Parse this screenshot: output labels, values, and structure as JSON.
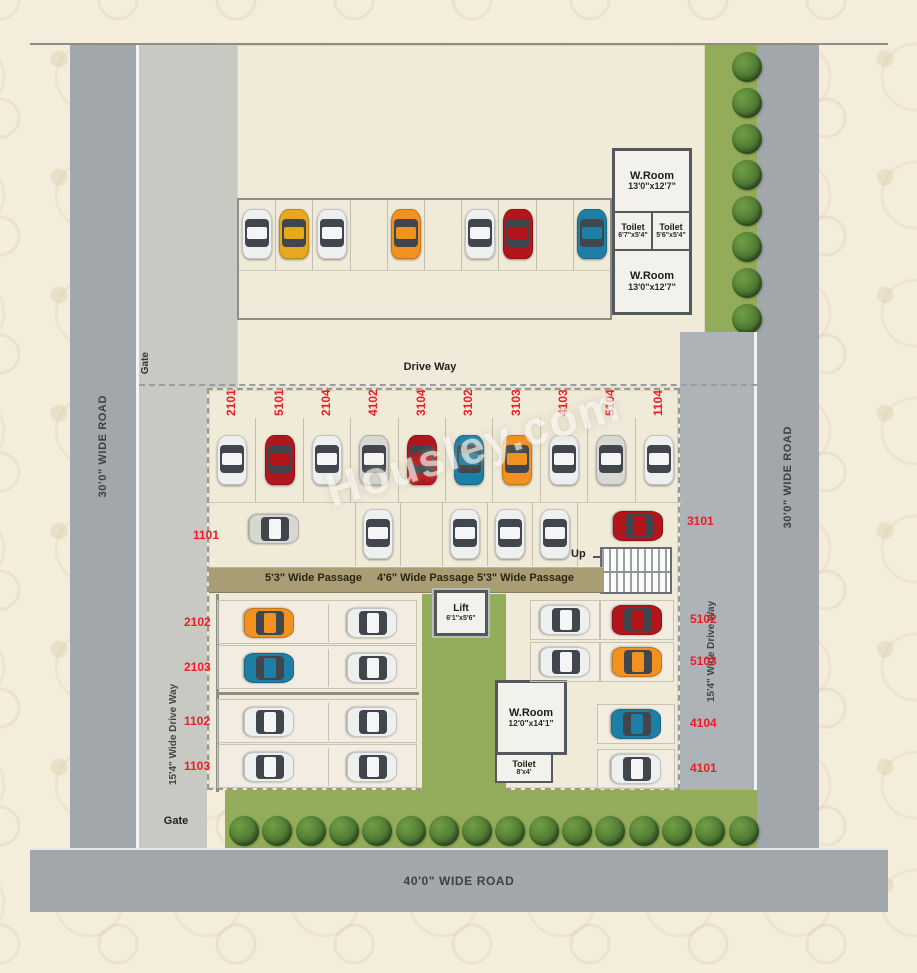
{
  "watermark": "Housley.com",
  "colors": {
    "accent_label": "#ee1c25",
    "road": "#a2a7ac",
    "lane": "#c9c9c3",
    "plot": "#f0ead9",
    "passage": "#a89d73",
    "green": "#93ac59",
    "wall": "#54575b"
  },
  "car_colors": {
    "white": "#eef0ef",
    "silver": "#d7d8d4",
    "red": "#b3151d",
    "orange": "#f29120",
    "gold": "#e6a91e",
    "blue": "#1e7fa6"
  },
  "roads": {
    "left": "30'0\" WIDE ROAD",
    "right": "30'0\" WIDE ROAD",
    "bottom": "40'0\" WIDE ROAD"
  },
  "site": {
    "drive_way": "Drive Way",
    "gate_top": "Gate",
    "gate_bottom": "Gate",
    "up": "Up",
    "left_inner_drive": "15'4\" Wide Drive Way",
    "right_inner_drive": "15'4\" Wide Drive Way",
    "passages": [
      "5'3\" Wide Passage",
      "4'6\" Wide Passage",
      "5'3\" Wide Passage"
    ]
  },
  "rooms": {
    "top_wroom_a": {
      "name": "W.Room",
      "size": "13'0\"x12'7\""
    },
    "top_toilet_a": {
      "name": "Toilet",
      "size": "6'7\"x5'4\""
    },
    "top_toilet_b": {
      "name": "Toilet",
      "size": "5'6\"x5'4\""
    },
    "top_wroom_b": {
      "name": "W.Room",
      "size": "13'0\"x12'7\""
    },
    "lift": {
      "name": "Lift",
      "size": "6'1\"x5'6\""
    },
    "mid_wroom": {
      "name": "W.Room",
      "size": "12'0\"x14'1\""
    },
    "mid_toilet": {
      "name": "Toilet",
      "size": "8'x4'"
    }
  },
  "top_parking": {
    "slots": [
      "white",
      "gold",
      "white",
      null,
      "orange",
      null,
      "white",
      "red",
      null,
      "blue"
    ]
  },
  "main_parking": {
    "numbered_row": [
      {
        "label": "2101",
        "car": "white"
      },
      {
        "label": "5101",
        "car": "red"
      },
      {
        "label": "2104",
        "car": "white"
      },
      {
        "label": "4102",
        "car": "silver"
      },
      {
        "label": "3104",
        "car": "red"
      },
      {
        "label": "3102",
        "car": "blue"
      },
      {
        "label": "3103",
        "car": "orange"
      },
      {
        "label": "4103",
        "car": "white"
      },
      {
        "label": "5104",
        "car": "silver"
      },
      {
        "label": "1104",
        "car": "white"
      }
    ],
    "row2": {
      "left": {
        "label": "1101",
        "car": "silver"
      },
      "middle_cars": [
        "white",
        "white",
        "white",
        "white"
      ],
      "right": {
        "label": "3101",
        "car": "red"
      }
    },
    "lower_left_rows": [
      {
        "label": "2102",
        "cars": [
          "orange",
          "white"
        ]
      },
      {
        "label": "2103",
        "cars": [
          "blue",
          "white"
        ]
      },
      {
        "label": "1102",
        "cars": [
          "white",
          "white"
        ]
      },
      {
        "label": "1103",
        "cars": [
          "white",
          "white"
        ]
      }
    ],
    "lower_right_rows": [
      {
        "label": "5102",
        "cars": [
          "white",
          "red"
        ]
      },
      {
        "label": "5103",
        "cars": [
          "white",
          "orange"
        ]
      },
      {
        "label": "4104",
        "cars": [
          "blue"
        ]
      },
      {
        "label": "4101",
        "cars": [
          "white"
        ]
      }
    ]
  },
  "trees": {
    "right_count": 8,
    "bottom_count": 16
  }
}
